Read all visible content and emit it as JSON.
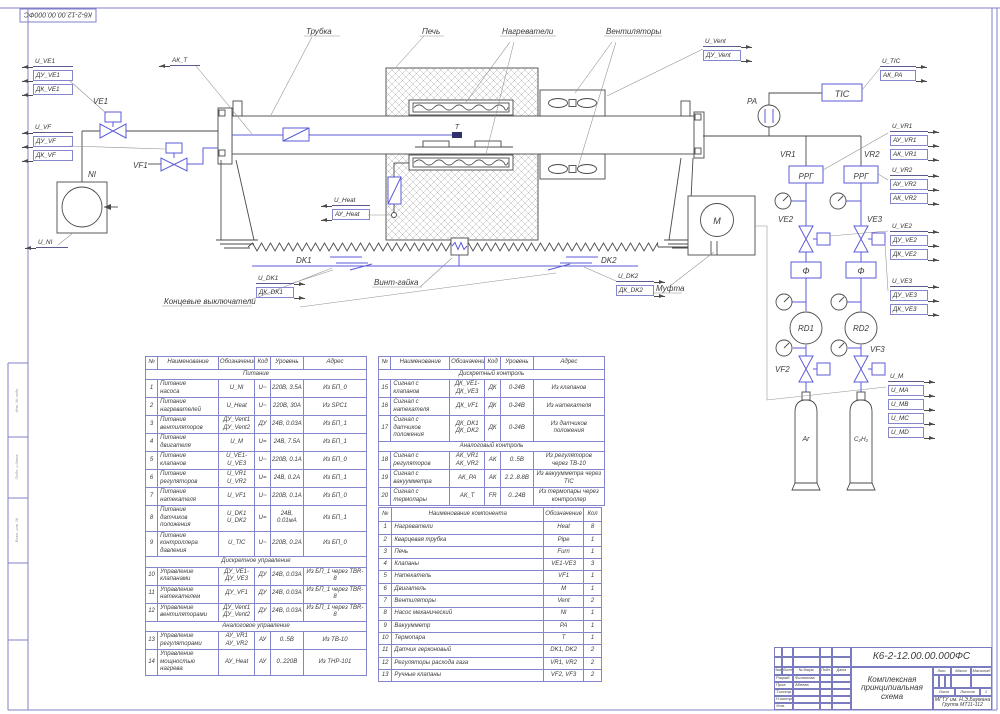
{
  "sheet": {
    "stamp_doc_number": "К6-2-12.00.00.000ФС",
    "doc_number": "К6-2-12.00.00.000ФС",
    "title_line1": "Комплексная",
    "title_line2": "принципиальная схема",
    "org_line1": "МГТУ им. Н.Э.Баумана",
    "org_line2": "Группа МТ11-112",
    "margin_labels": [
      "Инв. № подл.",
      "Подп. и дата",
      "Взам. инв. №"
    ],
    "title_block": {
      "rev_headers": [
        "Изм.",
        "Лист",
        "№ докум.",
        "Подп.",
        "Дата"
      ],
      "roles": [
        [
          "Разраб.",
          "Филатова"
        ],
        [
          "Пров.",
          "Абеева"
        ],
        [
          "Т.контр.",
          ""
        ],
        [
          "Н.контр.",
          ""
        ],
        [
          "Утв.",
          ""
        ]
      ],
      "lit_headers": [
        "Лит.",
        "Масса",
        "Масштаб"
      ],
      "sheet_row": [
        "Лист",
        "Листов",
        "1"
      ]
    }
  },
  "labels": {
    "tube": "Трубка",
    "furnace": "Печь",
    "heaters": "Нагреватели",
    "fans": "Вентиляторы",
    "screw": "Винт-гайка",
    "limit_switches": "Концевые выключатели",
    "coupling": "Муфта"
  },
  "tags": {
    "ve1": "VE1",
    "vf1": "VF1",
    "ni": "NI",
    "dk1": "DK1",
    "dk2": "DK2",
    "t": "T",
    "pa": "PA",
    "tic": "TIC",
    "vr1": "VR1",
    "vr2": "VR2",
    "rrg": "РРГ",
    "ve2": "VE2",
    "ve3": "VE3",
    "filter": "Ф",
    "rd1": "RD1",
    "rd2": "RD2",
    "vf2": "VF2",
    "vf3": "VF3",
    "ar": "Ar",
    "c2h2": "С₂Н₂",
    "m": "M"
  },
  "signal_blocks": [
    {
      "id": "ve1",
      "rows": [
        {
          "t": "U_VE1",
          "b": false
        },
        {
          "t": "ДУ_VE1",
          "b": true
        },
        {
          "t": "ДК_VE1",
          "b": true
        }
      ]
    },
    {
      "id": "vf",
      "rows": [
        {
          "t": "U_VF",
          "b": false
        },
        {
          "t": "ДУ_VF",
          "b": true
        },
        {
          "t": "ДК_VF",
          "b": true
        }
      ]
    },
    {
      "id": "ni",
      "rows": [
        {
          "t": "U_NI",
          "b": false
        }
      ]
    },
    {
      "id": "akt",
      "rows": [
        {
          "t": "АК_Т",
          "b": false
        }
      ]
    },
    {
      "id": "heat",
      "rows": [
        {
          "t": "U_Heat",
          "b": false
        },
        {
          "t": "АУ_Heat",
          "b": true
        }
      ]
    },
    {
      "id": "vent",
      "rows": [
        {
          "t": "U_Vent",
          "b": false
        },
        {
          "t": "ДУ_Vent",
          "b": true
        }
      ]
    },
    {
      "id": "dk1",
      "rows": [
        {
          "t": "U_DK1",
          "b": false
        },
        {
          "t": "ДК_DK1",
          "b": true
        }
      ]
    },
    {
      "id": "dk2",
      "rows": [
        {
          "t": "U_DK2",
          "b": false
        },
        {
          "t": "ДК_DK2",
          "b": true
        }
      ]
    },
    {
      "id": "tic",
      "rows": [
        {
          "t": "U_TIC",
          "b": false
        },
        {
          "t": "АК_РА",
          "b": true
        }
      ]
    },
    {
      "id": "vr1",
      "rows": [
        {
          "t": "U_VR1",
          "b": false
        },
        {
          "t": "АУ_VR1",
          "b": true
        },
        {
          "t": "АК_VR1",
          "b": true
        }
      ]
    },
    {
      "id": "vr2",
      "rows": [
        {
          "t": "U_VR2",
          "b": false
        },
        {
          "t": "АУ_VR2",
          "b": true
        },
        {
          "t": "АК_VR2",
          "b": true
        }
      ]
    },
    {
      "id": "ve2",
      "rows": [
        {
          "t": "U_VE2",
          "b": false
        },
        {
          "t": "ДУ_VE2",
          "b": true
        },
        {
          "t": "ДК_VE2",
          "b": true
        }
      ]
    },
    {
      "id": "ve3",
      "rows": [
        {
          "t": "U_VE3",
          "b": false
        },
        {
          "t": "ДУ_VE3",
          "b": true
        },
        {
          "t": "ДК_VE3",
          "b": true
        }
      ]
    },
    {
      "id": "m",
      "rows": [
        {
          "t": "U_M",
          "b": false
        },
        {
          "t": "U_MA",
          "b": true
        },
        {
          "t": "U_MB",
          "b": true
        },
        {
          "t": "U_MC",
          "b": true
        },
        {
          "t": "U_MD",
          "b": true
        }
      ]
    }
  ],
  "tables": {
    "io": {
      "name": "io-table",
      "headers": [
        "№",
        "Наименование",
        "Обозначение",
        "Код",
        "Уровень",
        "Адрес"
      ],
      "widths": [
        5.5,
        27.5,
        16.5,
        7,
        15,
        28.5
      ],
      "sections": [
        {
          "title": "Питание",
          "rows": [
            [
              "1",
              "Питание\nнасоса",
              "U_NI",
              "U~",
              "220В, 3.5А",
              "Из БП_0"
            ],
            [
              "2",
              "Питание\nнагревателей",
              "U_Heat",
              "U~",
              "220В, 30А",
              "Из SPC1"
            ],
            [
              "3",
              "Питание\nвентиляторов",
              "ДУ_Vent1\nДУ_Vent2",
              "ДУ",
              "24В, 0.03А",
              "Из БП_1"
            ],
            [
              "4",
              "Питание\nдвигателя",
              "U_M",
              "U=",
              "24В, 7.5А",
              "Из БП_1"
            ],
            [
              "5",
              "Питание\nклапанов",
              "U_VE1-\nU_VE3",
              "U~",
              "220В, 0.1А",
              "Из БП_0"
            ],
            [
              "6",
              "Питание\nрегуляторов",
              "U_VR1\nU_VR2",
              "U=",
              "24В, 0.2А",
              "Из БП_1"
            ],
            [
              "7",
              "Питание\nнатекателя",
              "U_VF1",
              "U~",
              "220В, 0.1А",
              "Из БП_0"
            ],
            [
              "8",
              "Питание\nдатчиков\nположения",
              "U_DK1\nU_DK2",
              "U=",
              "24В, 0.01мА",
              "Из БП_1"
            ],
            [
              "9",
              "Питание\nконтроллера\nдавления",
              "U_TIC",
              "U~",
              "220В, 0.2А",
              "Из БП_0"
            ]
          ]
        },
        {
          "title": "Дискретное управление",
          "rows": [
            [
              "10",
              "Управление\nклапанами",
              "ДУ_VE1-\nДУ_VE3",
              "ДУ",
              "24В, 0.03А",
              "Из БП_1 через TBR-8"
            ],
            [
              "11",
              "Управление\nнатекателем",
              "ДУ_VF1",
              "ДУ",
              "24В, 0.03А",
              "Из БП_1 через TBR-8"
            ],
            [
              "12",
              "Управление\nвентиляторами",
              "ДУ_Vent1\nДУ_Vent2",
              "ДУ",
              "24В, 0.03А",
              "Из БП_1 через TBR-8"
            ]
          ]
        },
        {
          "title": "Аналоговое управление",
          "rows": [
            [
              "13",
              "Управление\nрегуляторами",
              "АУ_VR1\nАУ_VR2",
              "АУ",
              "0..5В",
              "Из ТВ-10"
            ],
            [
              "14",
              "Управление\nмощностью\nнагрева",
              "АУ_Heat",
              "АУ",
              "0..220В",
              "Из ТНР-101"
            ]
          ]
        }
      ]
    },
    "mon": {
      "name": "monitoring-table",
      "headers": [
        "№",
        "Наименование",
        "Обозначение",
        "Код",
        "Уровень",
        "Адрес"
      ],
      "widths": [
        5.5,
        26,
        15.5,
        7,
        14.5,
        31.5
      ],
      "sections": [
        {
          "title": "Дискретный контроль",
          "rows": [
            [
              "15",
              "Сигнал с\nклапанов",
              "ДК_VE1-\nДК_VE3",
              "ДК",
              "0-24В",
              "Из клапанов"
            ],
            [
              "16",
              "Сигнал с\nнатекателя",
              "ДК_VF1",
              "ДК",
              "0-24В",
              "Из натекателя"
            ],
            [
              "17",
              "Сигнал с\nдатчиков\nположения",
              "ДК_DK1\nДК_DK2",
              "ДК",
              "0-24В",
              "Из датчиков\nположения"
            ]
          ]
        },
        {
          "title": "Аналоговый контроль",
          "rows": [
            [
              "18",
              "Сигнал с\nрегуляторов",
              "АК_VR1\nАК_VR2",
              "АК",
              "0..5В",
              "Из регуляторов\nчерез ТВ-10"
            ],
            [
              "19",
              "Сигнал с\nвакуумметра",
              "АК_РА",
              "АК",
              "2.2..8.8В",
              "Из вакуумметра через\nTIC"
            ],
            [
              "20",
              "Сигнал с\nтермопары",
              "АК_Т",
              "FR",
              "0..24В",
              "Из термопары через\nконтроллер"
            ]
          ]
        }
      ]
    },
    "comp": {
      "name": "components-table",
      "headers": [
        "№",
        "Наименование компонента",
        "Обозначение",
        "Кол"
      ],
      "widths": [
        6,
        68,
        18,
        8
      ],
      "sections": [
        {
          "rows": [
            [
              "1",
              "Нагреватели",
              "Heat",
              "8"
            ],
            [
              "2",
              "Кварцевая трубка",
              "Pipe",
              "1"
            ],
            [
              "3",
              "Печь",
              "Furn",
              "1"
            ],
            [
              "4",
              "Клапаны",
              "VE1-VE3",
              "3"
            ],
            [
              "5",
              "Натекатель",
              "VF1",
              "1"
            ],
            [
              "6",
              "Двигатель",
              "M",
              "1"
            ],
            [
              "7",
              "Вентиляторы",
              "Vent",
              "2"
            ],
            [
              "8",
              "Насос механический",
              "NI",
              "1"
            ],
            [
              "9",
              "Вакуумметр",
              "PA",
              "1"
            ],
            [
              "10",
              "Термопара",
              "T",
              "1"
            ],
            [
              "11",
              "Датчик герконовый",
              "DK1, DK2",
              "2"
            ],
            [
              "12",
              "Регуляторы расхода газа",
              "VR1, VR2",
              "2"
            ],
            [
              "13",
              "Ручные клапаны",
              "VF2, VF3",
              "2"
            ]
          ]
        }
      ]
    }
  }
}
